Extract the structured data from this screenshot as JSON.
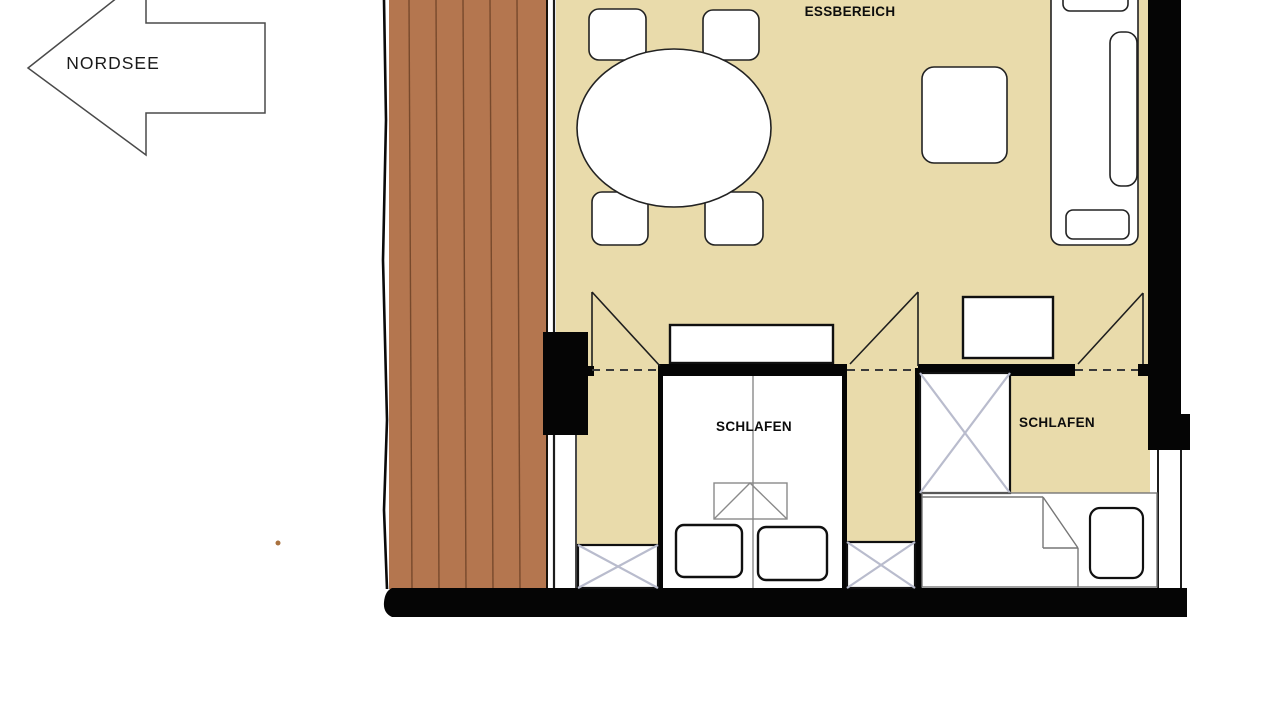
{
  "compass": {
    "label": "NORDSEE"
  },
  "rooms": {
    "dining": {
      "label": "ESSBEREICH"
    },
    "bedroom_left": {
      "label": "SCHLAFEN"
    },
    "bedroom_right": {
      "label": "SCHLAFEN"
    }
  },
  "colors": {
    "floor_beige": "#e9dbab",
    "deck_brown": "#b4764f",
    "deck_plank_line": "#77492c",
    "wall_black": "#050505",
    "wardrobe_cross": "#b9bccd",
    "furniture_outline": "#222222",
    "background": "#ffffff"
  }
}
